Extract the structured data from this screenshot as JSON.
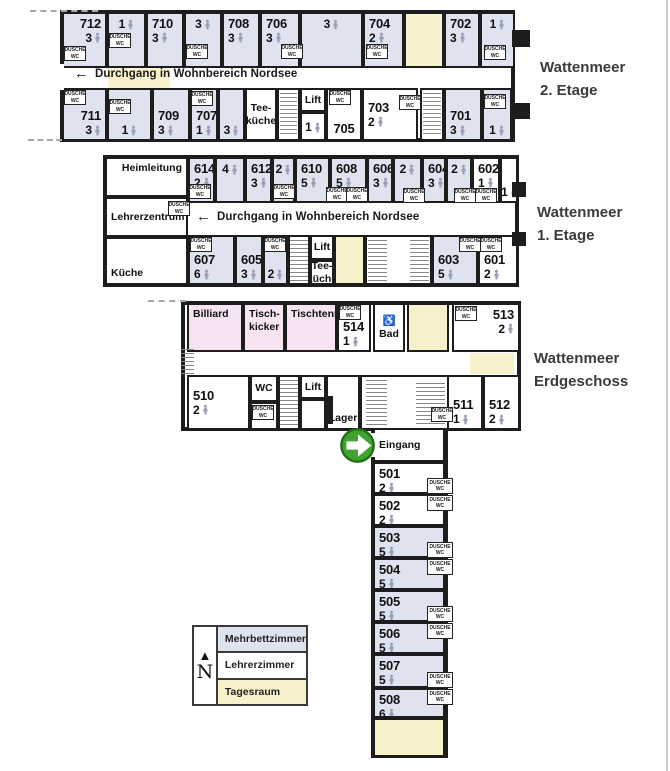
{
  "colors": {
    "room_blue": "#dfe3f0",
    "room_white": "#ffffff",
    "room_yellow": "#f7f2cc",
    "room_pink": "#f6e4f3",
    "wall": "#1d1d1d",
    "person_icon": "#99a0b5",
    "green_arrow": "#3fa32e",
    "green_arrow_ring": "#1e6f14"
  },
  "floor_labels": [
    {
      "id": "etage2",
      "line1": "Wattenmeer",
      "line2": "2. Etage"
    },
    {
      "id": "etage1",
      "line1": "Wattenmeer",
      "line2": "1. Etage"
    },
    {
      "id": "erdgeschoss",
      "line1": "Wattenmeer",
      "line2": "Erdgeschoss"
    }
  ],
  "banners": [
    {
      "arrow": "←",
      "text": "Durchgang in Wohnbereich Nordsee"
    },
    {
      "arrow": "←",
      "text": "Durchgang in Wohnbereich Nordsee"
    }
  ],
  "closet_label": {
    "line1": "DUSCHE",
    "line2": "WC"
  },
  "legend": {
    "compass_arrow": "▲",
    "compass": "N",
    "items": [
      {
        "label": "Mehrbettzimmer",
        "type": "m"
      },
      {
        "label": "Lehrerzimmer",
        "type": "l"
      },
      {
        "label": "Tagesraum",
        "type": "t"
      }
    ]
  },
  "outlines": [
    {
      "id": "etage2",
      "x": 60,
      "y": 10,
      "w": 455,
      "h": 132
    },
    {
      "id": "etage1",
      "x": 103,
      "y": 155,
      "w": 416,
      "h": 132
    },
    {
      "id": "erdgeschoss",
      "x": 181,
      "y": 301,
      "w": 340,
      "h": 130
    },
    {
      "id": "wing",
      "x": 371,
      "y": 427,
      "w": 77,
      "h": 331
    }
  ],
  "patches": [
    {
      "x": 108,
      "y": 55,
      "w": 62,
      "h": 33
    },
    {
      "x": 470,
      "y": 353,
      "w": 44,
      "h": 21
    }
  ],
  "cells": [
    {
      "x": 62,
      "y": 12,
      "w": 45,
      "h": 56,
      "t": "m",
      "n": "712",
      "b": "3",
      "lp": "t",
      "la": "r"
    },
    {
      "x": 107,
      "y": 12,
      "w": 39,
      "h": 56,
      "t": "m",
      "b": "1",
      "lp": "t"
    },
    {
      "x": 146,
      "y": 12,
      "w": 38,
      "h": 56,
      "t": "m",
      "n": "710",
      "b": "3",
      "lp": "t"
    },
    {
      "x": 184,
      "y": 12,
      "w": 38,
      "h": 56,
      "t": "m",
      "b": "3",
      "lp": "t"
    },
    {
      "x": 222,
      "y": 12,
      "w": 38,
      "h": 56,
      "t": "m",
      "n": "708",
      "b": "3",
      "lp": "t"
    },
    {
      "x": 260,
      "y": 12,
      "w": 40,
      "h": 56,
      "t": "m",
      "n": "706",
      "b": "3",
      "lp": "t"
    },
    {
      "x": 300,
      "y": 12,
      "w": 63,
      "h": 56,
      "t": "m",
      "b": "3",
      "lp": "t"
    },
    {
      "x": 363,
      "y": 12,
      "w": 41,
      "h": 56,
      "t": "m",
      "n": "704",
      "b": "2",
      "lp": "t"
    },
    {
      "x": 404,
      "y": 12,
      "w": 40,
      "h": 56,
      "t": "t"
    },
    {
      "x": 444,
      "y": 12,
      "w": 36,
      "h": 56,
      "t": "m",
      "n": "702",
      "b": "3",
      "lp": "t"
    },
    {
      "x": 480,
      "y": 12,
      "w": 35,
      "h": 56,
      "t": "m",
      "b": "1",
      "lp": "t"
    },
    {
      "x": 62,
      "y": 88,
      "w": 45,
      "h": 53,
      "t": "m",
      "n": "711",
      "b": "3",
      "lp": "b",
      "la": "r"
    },
    {
      "x": 107,
      "y": 88,
      "w": 45,
      "h": 53,
      "t": "m",
      "b": "1",
      "lp": "b"
    },
    {
      "x": 152,
      "y": 88,
      "w": 38,
      "h": 53,
      "t": "m",
      "n": "709",
      "b": "3",
      "lp": "b"
    },
    {
      "x": 190,
      "y": 88,
      "w": 28,
      "h": 53,
      "t": "m",
      "n": "707",
      "b": "1",
      "lp": "b"
    },
    {
      "x": 218,
      "y": 88,
      "w": 27,
      "h": 53,
      "t": "m",
      "b": "3",
      "lp": "b"
    },
    {
      "x": 245,
      "y": 88,
      "w": 32,
      "h": 53,
      "t": "s",
      "nm": "Tee-\nküche",
      "lp": "c"
    },
    {
      "x": 277,
      "y": 88,
      "w": 23,
      "h": 53,
      "t": "s"
    },
    {
      "x": 300,
      "y": 88,
      "w": 26,
      "h": 24,
      "t": "s",
      "nm": "Lift",
      "lp": "c"
    },
    {
      "x": 300,
      "y": 112,
      "w": 26,
      "h": 29,
      "t": "l",
      "b": "1",
      "lp": "c"
    },
    {
      "x": 326,
      "y": 88,
      "w": 36,
      "h": 53,
      "t": "l",
      "n": "705",
      "lp": "b",
      "la": "c"
    },
    {
      "x": 362,
      "y": 88,
      "w": 56,
      "h": 53,
      "t": "l",
      "n": "703",
      "b": "2",
      "lp": "c"
    },
    {
      "x": 420,
      "y": 88,
      "w": 24,
      "h": 53,
      "t": "s"
    },
    {
      "x": 444,
      "y": 88,
      "w": 38,
      "h": 53,
      "t": "m",
      "n": "701",
      "b": "3",
      "lp": "b"
    },
    {
      "x": 482,
      "y": 88,
      "w": 30,
      "h": 53,
      "t": "m",
      "b": "1",
      "lp": "b"
    },
    {
      "x": 105,
      "y": 157,
      "w": 83,
      "h": 40,
      "t": "l",
      "nm": "Heimleitung",
      "lp": "t",
      "la": "r"
    },
    {
      "x": 105,
      "y": 197,
      "w": 83,
      "h": 40,
      "t": "l",
      "nm": "Lehrerzentrum",
      "lp": "c",
      "la": "l"
    },
    {
      "x": 105,
      "y": 237,
      "w": 83,
      "h": 48,
      "t": "l",
      "nm": "Küche",
      "lp": "b",
      "la": "l"
    },
    {
      "x": 188,
      "y": 157,
      "w": 27,
      "h": 46,
      "t": "m",
      "n": "614",
      "b": "2",
      "lp": "t"
    },
    {
      "x": 215,
      "y": 157,
      "w": 30,
      "h": 46,
      "t": "m",
      "b": "4",
      "lp": "t"
    },
    {
      "x": 245,
      "y": 157,
      "w": 27,
      "h": 46,
      "t": "m",
      "n": "612",
      "b": "3",
      "lp": "t"
    },
    {
      "x": 272,
      "y": 157,
      "w": 23,
      "h": 46,
      "t": "m",
      "b": "2",
      "lp": "t"
    },
    {
      "x": 295,
      "y": 157,
      "w": 35,
      "h": 46,
      "t": "m",
      "n": "610",
      "b": "5",
      "lp": "t"
    },
    {
      "x": 330,
      "y": 157,
      "w": 37,
      "h": 46,
      "t": "m",
      "n": "608",
      "b": "5",
      "lp": "t"
    },
    {
      "x": 367,
      "y": 157,
      "w": 26,
      "h": 46,
      "t": "m",
      "n": "606",
      "b": "3",
      "lp": "t"
    },
    {
      "x": 393,
      "y": 157,
      "w": 29,
      "h": 46,
      "t": "m",
      "b": "2",
      "lp": "t"
    },
    {
      "x": 422,
      "y": 157,
      "w": 24,
      "h": 46,
      "t": "m",
      "n": "604",
      "b": "3",
      "lp": "t"
    },
    {
      "x": 446,
      "y": 157,
      "w": 26,
      "h": 46,
      "t": "m",
      "b": "2",
      "lp": "t"
    },
    {
      "x": 472,
      "y": 157,
      "w": 28,
      "h": 46,
      "t": "l",
      "n": "602",
      "b": "1",
      "lp": "t"
    },
    {
      "x": 500,
      "y": 157,
      "w": 18,
      "h": 46,
      "t": "l",
      "b": "1",
      "lp": "b"
    },
    {
      "x": 188,
      "y": 235,
      "w": 47,
      "h": 50,
      "t": "m",
      "n": "607",
      "b": "6",
      "lp": "b"
    },
    {
      "x": 235,
      "y": 235,
      "w": 28,
      "h": 50,
      "t": "m",
      "n": "605",
      "b": "3",
      "lp": "b"
    },
    {
      "x": 263,
      "y": 235,
      "w": 25,
      "h": 50,
      "t": "m",
      "b": "2",
      "lp": "b"
    },
    {
      "x": 288,
      "y": 235,
      "w": 22,
      "h": 50,
      "t": "s"
    },
    {
      "x": 310,
      "y": 235,
      "w": 24,
      "h": 25,
      "t": "s",
      "nm": "Lift",
      "lp": "c"
    },
    {
      "x": 310,
      "y": 260,
      "w": 24,
      "h": 25,
      "t": "s",
      "nm": "Tee-\nküche",
      "lp": "c"
    },
    {
      "x": 334,
      "y": 235,
      "w": 31,
      "h": 50,
      "t": "t"
    },
    {
      "x": 365,
      "y": 235,
      "w": 67,
      "h": 50,
      "t": "s"
    },
    {
      "x": 432,
      "y": 235,
      "w": 46,
      "h": 50,
      "t": "m",
      "n": "603",
      "b": "5",
      "lp": "b"
    },
    {
      "x": 478,
      "y": 235,
      "w": 40,
      "h": 50,
      "t": "l",
      "n": "601",
      "b": "2",
      "lp": "b"
    },
    {
      "x": 187,
      "y": 303,
      "w": 56,
      "h": 49,
      "t": "p",
      "nm": "Billiard",
      "lp": "t",
      "la": "l"
    },
    {
      "x": 243,
      "y": 303,
      "w": 42,
      "h": 49,
      "t": "p",
      "nm": "Tisch-\nkicker",
      "lp": "t",
      "la": "l"
    },
    {
      "x": 285,
      "y": 303,
      "w": 52,
      "h": 49,
      "t": "p",
      "nm": "Tischtennis",
      "lp": "t",
      "la": "l"
    },
    {
      "x": 337,
      "y": 303,
      "w": 34,
      "h": 49,
      "t": "l",
      "n": "514",
      "b": "1",
      "lp": "b"
    },
    {
      "x": 373,
      "y": 303,
      "w": 32,
      "h": 49,
      "t": "s",
      "nm": "♿\nBad",
      "lp": "c"
    },
    {
      "x": 407,
      "y": 303,
      "w": 42,
      "h": 49,
      "t": "t"
    },
    {
      "x": 452,
      "y": 303,
      "w": 68,
      "h": 49,
      "t": "l",
      "n": "513",
      "b": "2",
      "lp": "t",
      "la": "r"
    },
    {
      "x": 187,
      "y": 375,
      "w": 63,
      "h": 55,
      "t": "l",
      "n": "510",
      "b": "2",
      "lp": "c"
    },
    {
      "x": 250,
      "y": 375,
      "w": 28,
      "h": 27,
      "t": "s",
      "nm": "WC",
      "lp": "c"
    },
    {
      "x": 250,
      "y": 402,
      "w": 28,
      "h": 28,
      "t": "s"
    },
    {
      "x": 278,
      "y": 375,
      "w": 22,
      "h": 55,
      "t": "s"
    },
    {
      "x": 300,
      "y": 375,
      "w": 26,
      "h": 24,
      "t": "s",
      "nm": "Lift",
      "lp": "c"
    },
    {
      "x": 300,
      "y": 399,
      "w": 26,
      "h": 31,
      "t": "s"
    },
    {
      "x": 326,
      "y": 375,
      "w": 34,
      "h": 55,
      "t": "s",
      "nm": "Lager",
      "lp": "b"
    },
    {
      "x": 360,
      "y": 375,
      "w": 95,
      "h": 55,
      "t": "s"
    },
    {
      "x": 447,
      "y": 375,
      "w": 36,
      "h": 55,
      "t": "l",
      "n": "511",
      "b": "1",
      "lp": "b"
    },
    {
      "x": 483,
      "y": 375,
      "w": 37,
      "h": 55,
      "t": "l",
      "n": "512",
      "b": "2",
      "lp": "b"
    },
    {
      "x": 373,
      "y": 428,
      "w": 72,
      "h": 34,
      "t": "s",
      "nm": "Eingang",
      "lp": "c",
      "la": "l"
    },
    {
      "x": 373,
      "y": 462,
      "w": 72,
      "h": 32,
      "t": "l",
      "n": "501",
      "b": "2",
      "lp": "t"
    },
    {
      "x": 373,
      "y": 494,
      "w": 72,
      "h": 32,
      "t": "l",
      "n": "502",
      "b": "2",
      "lp": "t"
    },
    {
      "x": 373,
      "y": 526,
      "w": 72,
      "h": 32,
      "t": "m",
      "n": "503",
      "b": "5",
      "lp": "t"
    },
    {
      "x": 373,
      "y": 558,
      "w": 72,
      "h": 32,
      "t": "m",
      "n": "504",
      "b": "5",
      "lp": "t"
    },
    {
      "x": 373,
      "y": 590,
      "w": 72,
      "h": 32,
      "t": "m",
      "n": "505",
      "b": "5",
      "lp": "t"
    },
    {
      "x": 373,
      "y": 622,
      "w": 72,
      "h": 32,
      "t": "m",
      "n": "506",
      "b": "5",
      "lp": "t"
    },
    {
      "x": 373,
      "y": 654,
      "w": 72,
      "h": 34,
      "t": "m",
      "n": "507",
      "b": "5",
      "lp": "t"
    },
    {
      "x": 373,
      "y": 688,
      "w": 72,
      "h": 30,
      "t": "m",
      "n": "508",
      "b": "6",
      "lp": "t"
    },
    {
      "x": 373,
      "y": 718,
      "w": 72,
      "h": 39,
      "t": "t"
    }
  ],
  "closets": [
    {
      "x": 64,
      "y": 46
    },
    {
      "x": 109,
      "y": 33
    },
    {
      "x": 186,
      "y": 44
    },
    {
      "x": 281,
      "y": 44
    },
    {
      "x": 366,
      "y": 44
    },
    {
      "x": 484,
      "y": 45
    },
    {
      "x": 64,
      "y": 90
    },
    {
      "x": 109,
      "y": 99
    },
    {
      "x": 191,
      "y": 91
    },
    {
      "x": 329,
      "y": 90
    },
    {
      "x": 399,
      "y": 95
    },
    {
      "x": 484,
      "y": 94
    },
    {
      "x": 168,
      "y": 201
    },
    {
      "x": 189,
      "y": 184
    },
    {
      "x": 273,
      "y": 184
    },
    {
      "x": 326,
      "y": 187
    },
    {
      "x": 346,
      "y": 187
    },
    {
      "x": 403,
      "y": 188
    },
    {
      "x": 454,
      "y": 188
    },
    {
      "x": 475,
      "y": 188
    },
    {
      "x": 190,
      "y": 237
    },
    {
      "x": 264,
      "y": 237
    },
    {
      "x": 459,
      "y": 237
    },
    {
      "x": 480,
      "y": 237
    },
    {
      "x": 339,
      "y": 305
    },
    {
      "x": 455,
      "y": 306
    },
    {
      "x": 252,
      "y": 405
    },
    {
      "x": 431,
      "y": 407
    },
    {
      "x": 427,
      "y": 478,
      "w": 26,
      "h": 16
    },
    {
      "x": 427,
      "y": 495,
      "w": 26,
      "h": 16
    },
    {
      "x": 427,
      "y": 542,
      "w": 26,
      "h": 16
    },
    {
      "x": 427,
      "y": 559,
      "w": 26,
      "h": 16
    },
    {
      "x": 427,
      "y": 606,
      "w": 26,
      "h": 16
    },
    {
      "x": 427,
      "y": 623,
      "w": 26,
      "h": 16
    },
    {
      "x": 427,
      "y": 672,
      "w": 26,
      "h": 16
    },
    {
      "x": 427,
      "y": 689,
      "w": 26,
      "h": 16
    }
  ],
  "stairs": [
    {
      "x": 280,
      "y": 93,
      "w": 17,
      "h": 43
    },
    {
      "x": 423,
      "y": 93,
      "w": 18,
      "h": 43
    },
    {
      "x": 290,
      "y": 240,
      "w": 18,
      "h": 41
    },
    {
      "x": 368,
      "y": 240,
      "w": 19,
      "h": 41
    },
    {
      "x": 410,
      "y": 240,
      "w": 19,
      "h": 41
    },
    {
      "x": 181,
      "y": 349,
      "w": 13,
      "h": 28
    },
    {
      "x": 280,
      "y": 380,
      "w": 18,
      "h": 46
    },
    {
      "x": 366,
      "y": 380,
      "w": 21,
      "h": 46
    },
    {
      "x": 416,
      "y": 383,
      "w": 29,
      "h": 43
    }
  ],
  "walls": [
    {
      "x": 512,
      "y": 30,
      "w": 18,
      "h": 17
    },
    {
      "x": 512,
      "y": 103,
      "w": 18,
      "h": 16
    },
    {
      "x": 512,
      "y": 182,
      "w": 14,
      "h": 15
    },
    {
      "x": 512,
      "y": 232,
      "w": 14,
      "h": 14
    },
    {
      "x": 326,
      "y": 396,
      "w": 7,
      "h": 28
    }
  ],
  "gaps": [
    {
      "x": 56,
      "y": 64,
      "w": 8,
      "h": 26
    },
    {
      "x": 369,
      "y": 433,
      "w": 7,
      "h": 24
    }
  ],
  "dashes": [
    {
      "x": 30,
      "y": 10,
      "l": 68
    },
    {
      "x": 28,
      "y": 139,
      "l": 72
    },
    {
      "x": 148,
      "y": 300,
      "l": 38
    }
  ],
  "entrance": {
    "label": "Eingang"
  }
}
